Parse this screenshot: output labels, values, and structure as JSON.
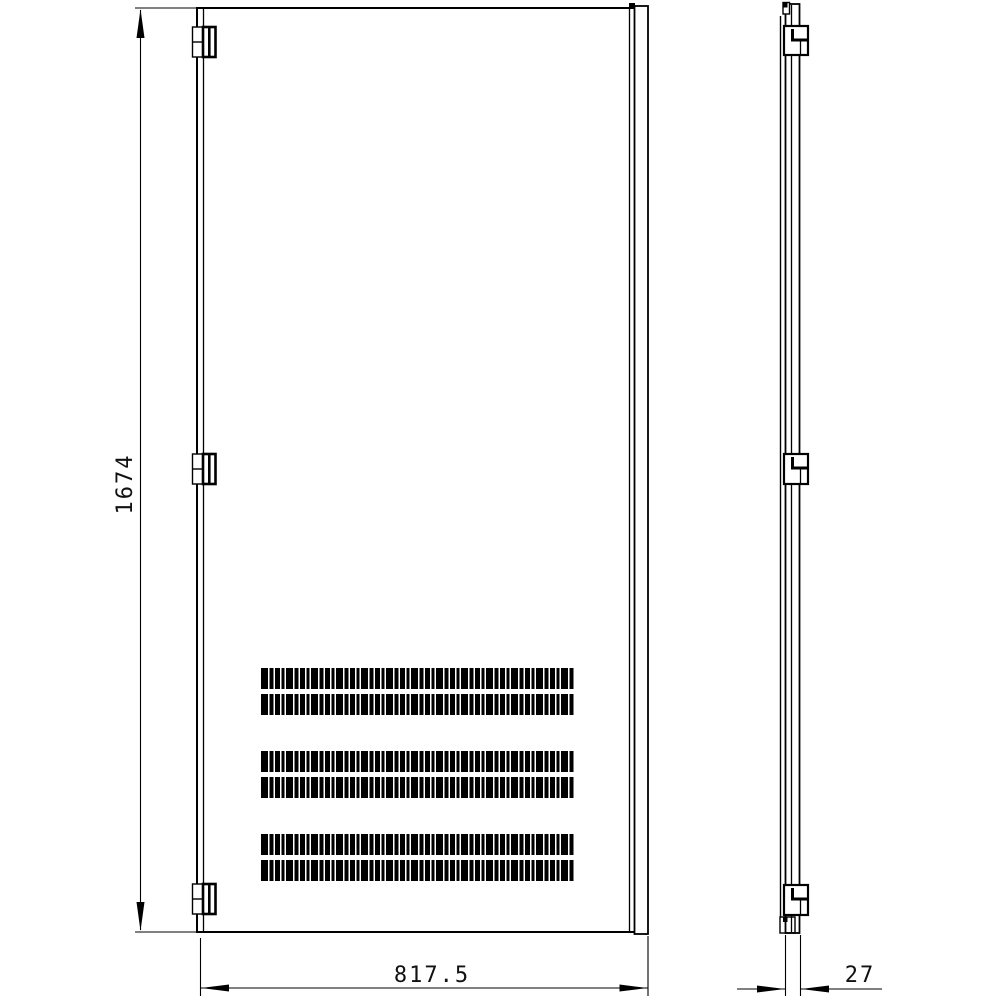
{
  "drawing": {
    "dimensions": {
      "height": "1674",
      "width": "817.5",
      "thickness": "27"
    },
    "colors": {
      "line": "#000000",
      "background": "#ffffff",
      "text": "#111111"
    }
  }
}
